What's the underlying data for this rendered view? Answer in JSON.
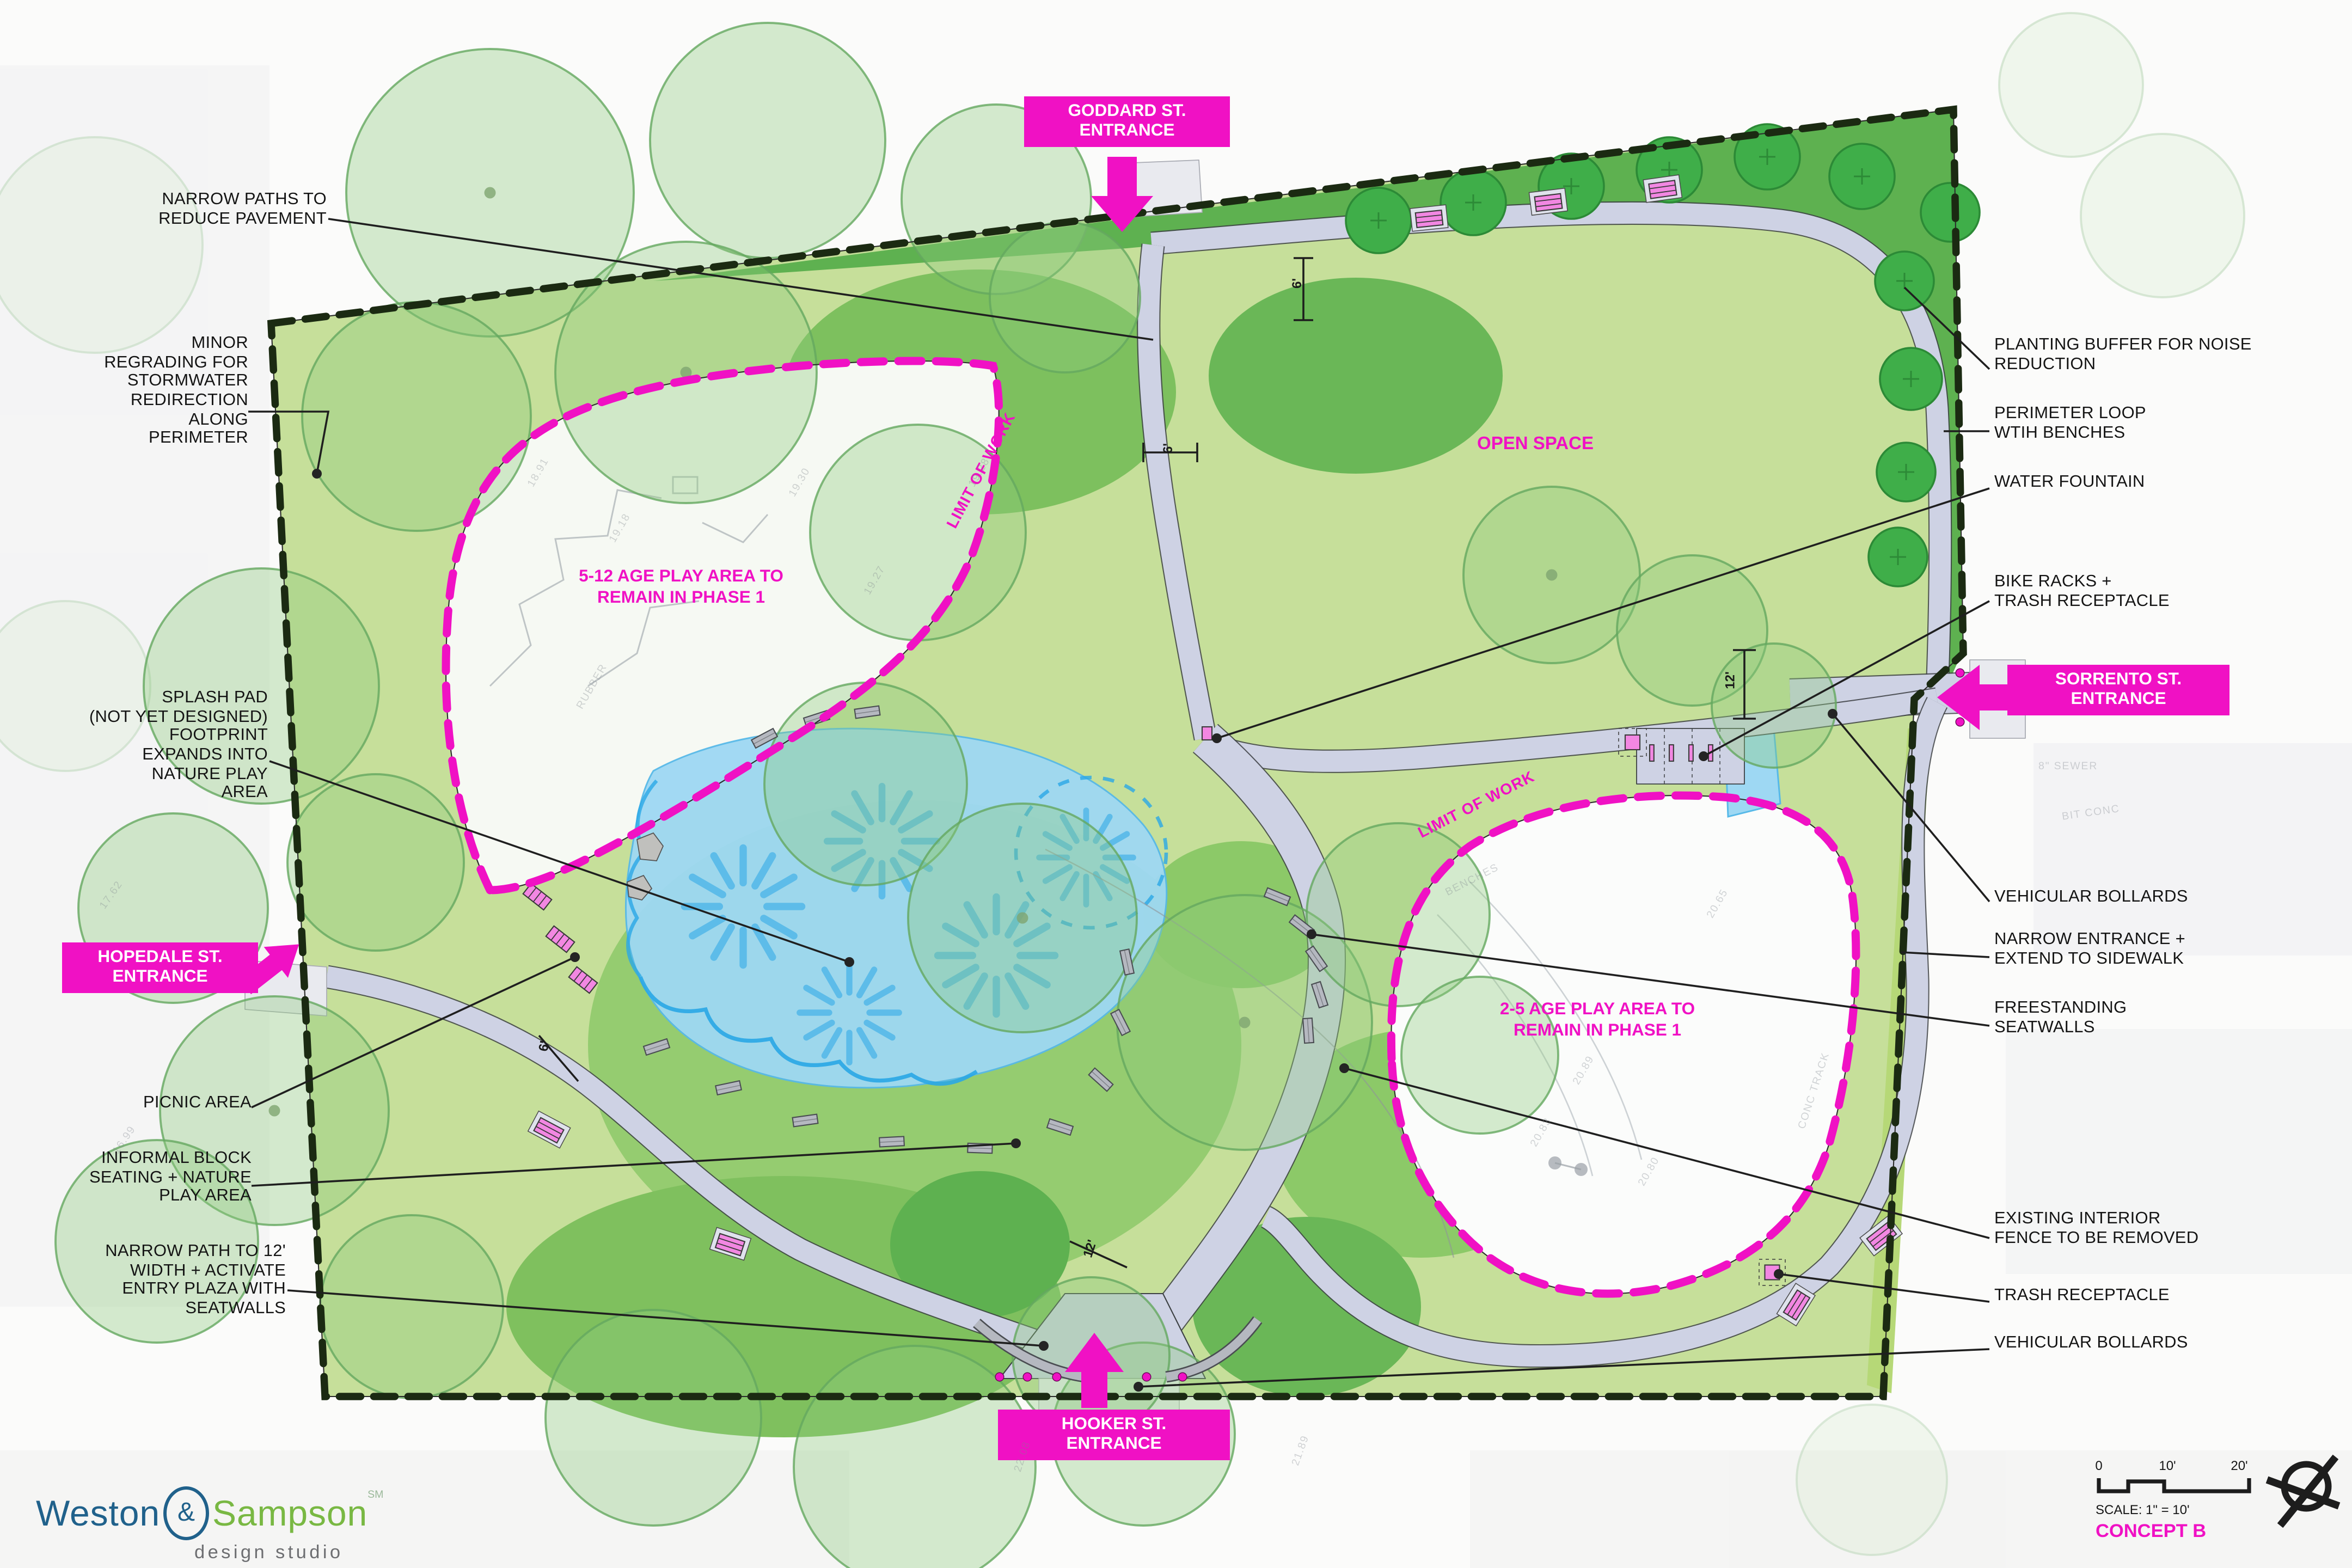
{
  "colors": {
    "magenta": "#f011c4",
    "furniture_pink": "#f287e2",
    "lawn": "#c6df9a",
    "grass_dark": "#5eb150",
    "path": "#ced2e4",
    "splash_blue": "#9ed8f3",
    "spray_blue": "#45b2e8",
    "boundary": "#1b2a12",
    "logo_blue": "#20618b",
    "logo_green": "#79b843",
    "logo_gray": "#6d6e71"
  },
  "callouts_left": [
    {
      "text": "NARROW PATHS TO\nREDUCE PAVEMENT"
    },
    {
      "text": "MINOR\nREGRADING FOR\nSTORMWATER\nREDIRECTION\nALONG\nPERIMETER"
    },
    {
      "text": "SPLASH PAD\n(NOT YET DESIGNED)\nFOOTPRINT\nEXPANDS INTO\nNATURE PLAY\nAREA"
    },
    {
      "text": "PICNIC AREA"
    },
    {
      "text": "INFORMAL BLOCK\nSEATING + NATURE\nPLAY AREA"
    },
    {
      "text": "NARROW PATH TO 12'\nWIDTH + ACTIVATE\nENTRY PLAZA WITH\nSEATWALLS"
    }
  ],
  "callouts_right": [
    {
      "text": "PLANTING BUFFER FOR NOISE\nREDUCTION"
    },
    {
      "text": "PERIMETER LOOP\nWTIH BENCHES"
    },
    {
      "text": "WATER FOUNTAIN"
    },
    {
      "text": "BIKE RACKS +\nTRASH RECEPTACLE"
    },
    {
      "text": "VEHICULAR BOLLARDS"
    },
    {
      "text": "NARROW ENTRANCE +\nEXTEND TO SIDEWALK"
    },
    {
      "text": "FREESTANDING\nSEATWALLS"
    },
    {
      "text": "EXISTING INTERIOR\nFENCE TO BE REMOVED"
    },
    {
      "text": "TRASH RECEPTACLE"
    },
    {
      "text": "VEHICULAR BOLLARDS"
    }
  ],
  "entrances": [
    {
      "label": "GODDARD ST.\nENTRANCE"
    },
    {
      "label": "SORRENTO ST.\nENTRANCE"
    },
    {
      "label": "HOPEDALE ST.\nENTRANCE"
    },
    {
      "label": "HOOKER ST.\nENTRANCE"
    }
  ],
  "area_labels": [
    {
      "text": "5-12 AGE PLAY AREA TO\nREMAIN IN PHASE 1"
    },
    {
      "text": "OPEN SPACE"
    },
    {
      "text": "2-5 AGE PLAY AREA TO\nREMAIN IN PHASE 1"
    }
  ],
  "limit_of_work": [
    {
      "text": "LIMIT OF WORK"
    },
    {
      "text": "LIMIT OF WORK"
    }
  ],
  "path_widths": [
    {
      "text": "6'"
    },
    {
      "text": "6'"
    },
    {
      "text": "6'"
    },
    {
      "text": "12'"
    },
    {
      "text": "12'"
    }
  ],
  "survey_marks": [
    {
      "text": "19.18"
    },
    {
      "text": "18.91"
    },
    {
      "text": "19.30"
    },
    {
      "text": "19.27"
    },
    {
      "text": "19.28"
    },
    {
      "text": "RUBBER"
    },
    {
      "text": "20.89"
    },
    {
      "text": "20.83"
    },
    {
      "text": "20.80"
    },
    {
      "text": "20.65"
    },
    {
      "text": "CONC TRACK"
    },
    {
      "text": "BENCHES"
    },
    {
      "text": "8\" SEWER"
    },
    {
      "text": "BIT CONC"
    },
    {
      "text": "22.08"
    },
    {
      "text": "21.89"
    },
    {
      "text": "17.62"
    },
    {
      "text": "16.99"
    }
  ],
  "footer": {
    "logo": {
      "weston": "Weston",
      "ampersand": "&",
      "sampson": "Sampson",
      "mark": "SM",
      "tagline": "design studio"
    },
    "scale_ticks": [
      {
        "t": "0"
      },
      {
        "t": "10'"
      },
      {
        "t": "20'"
      }
    ],
    "scale_text": "SCALE: 1\" = 10'",
    "concept": "CONCEPT B"
  }
}
